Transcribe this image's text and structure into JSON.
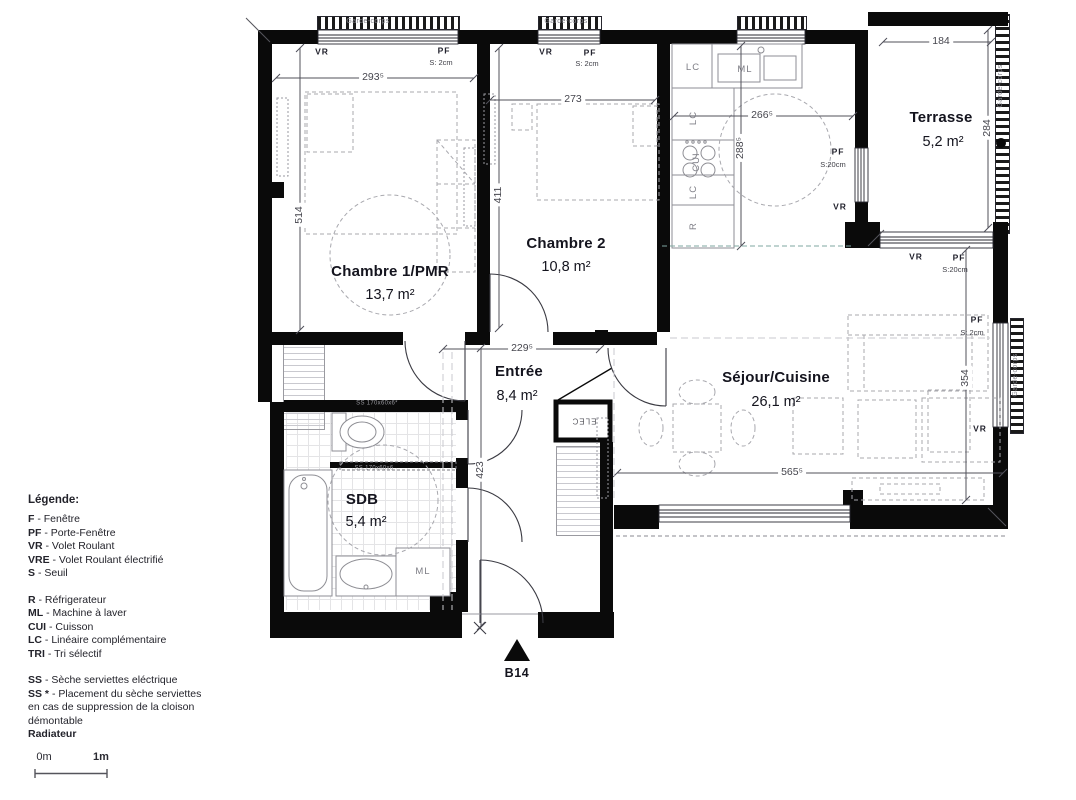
{
  "plan": {
    "rooms": [
      {
        "name": "Chambre 1/PMR",
        "area": "13,7 m²"
      },
      {
        "name": "Chambre 2",
        "area": "10,8 m²"
      },
      {
        "name": "Entrée",
        "area": "8,4 m²"
      },
      {
        "name": "SDB",
        "area": "5,4 m²"
      },
      {
        "name": "Séjour/Cuisine",
        "area": "26,1 m²"
      },
      {
        "name": "Terrasse",
        "area": "5,2 m²"
      }
    ],
    "dims": {
      "ch1_w": "293⁵",
      "ch2_w": "273",
      "kitchen_w": "266⁵",
      "terrasse_w": "184",
      "entree_w": "229⁵",
      "sejour_w": "565⁵",
      "ch1_h": "514",
      "ch2_h": "411",
      "kitchen_h": "288⁵",
      "terrasse_h": "284",
      "sejour_h": "354",
      "entree_h": "423"
    },
    "labels": {
      "vr": "VR",
      "pf": "PF",
      "s2": "S: 2cm",
      "s20": "S:20cm",
      "gc": "Garde-corps",
      "lc": "LC",
      "ml": "ML",
      "cui": "CUI",
      "r": "R",
      "elec": "ELEC",
      "ss_wc": "SS 170x60x6*",
      "ss_sdb": "SS 170x60x6"
    },
    "unit": "B14"
  },
  "legend": {
    "title": "Légende:",
    "items": [
      {
        "abbr": "F",
        "text": "- Fenêtre"
      },
      {
        "abbr": "PF",
        "text": "- Porte-Fenêtre"
      },
      {
        "abbr": "VR",
        "text": "- Volet Roulant"
      },
      {
        "abbr": "VRE",
        "text": "- Volet Roulant électrifié"
      },
      {
        "abbr": "S",
        "text": "- Seuil"
      },
      {
        "abbr": "R",
        "text": "- Réfrigerateur"
      },
      {
        "abbr": "ML",
        "text": "- Machine à laver"
      },
      {
        "abbr": "CUI",
        "text": "- Cuisson"
      },
      {
        "abbr": "LC",
        "text": "- Linéaire complémentaire"
      },
      {
        "abbr": "TRI",
        "text": "- Tri sélectif"
      },
      {
        "abbr": "SS",
        "text": "- Sèche serviettes eléctrique"
      },
      {
        "abbr": "SS *",
        "text": "- Placement du sèche serviettes en cas de suppression de la cloison démontable"
      }
    ],
    "radiator": "Radiateur"
  },
  "scalebar": {
    "start": "0m",
    "end": "1m"
  }
}
